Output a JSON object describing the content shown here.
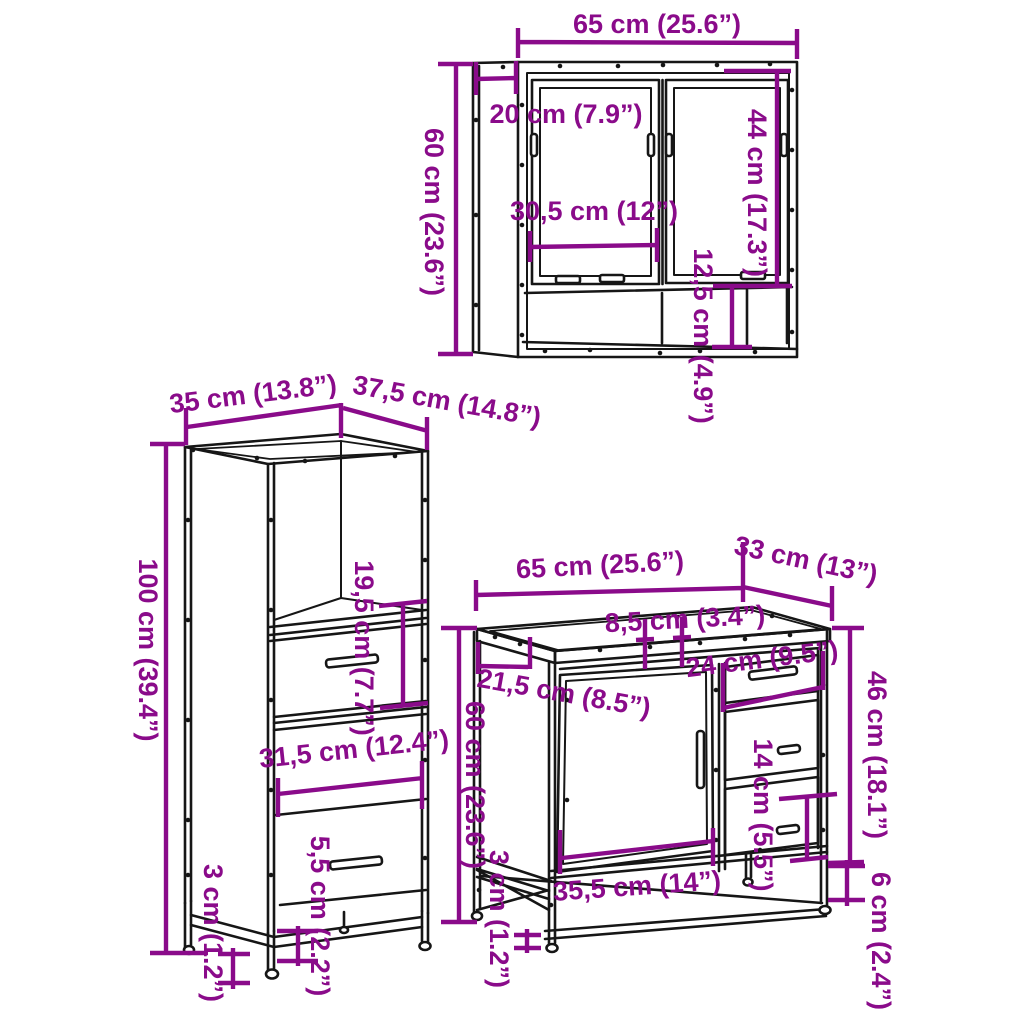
{
  "colors": {
    "dimension": "#8a0b8a",
    "outline": "#161616",
    "background": "#ffffff"
  },
  "mirror_cabinet": {
    "width": "65 cm (25.6”)",
    "height": "60 cm (23.6”)",
    "depth": "20 cm (7.9”)",
    "mirror_door_height": "44 cm (17.3”)",
    "mirror_door_width": "30,5 cm (12”)",
    "open_shelf_height": "12,5 cm (4.9”)"
  },
  "tall_cabinet": {
    "width": "35 cm (13.8”)",
    "depth": "37,5 cm (14.8”)",
    "height": "100 cm (39.4”)",
    "drawer_section_height": "19,5 cm (7.7”)",
    "inner_width": "31,5 cm (12.4”)",
    "clearance_height": "5,5 cm (2.2”)",
    "foot_height": "3 cm (1.2”)"
  },
  "sink_cabinet": {
    "width": "65 cm (25.6”)",
    "depth": "33 cm (13”)",
    "pipe_gap_width": "8,5 cm (3.4”)",
    "drawer_width": "24 cm (9.5”)",
    "top_side_depth": "21,5 cm (8.5”)",
    "height": "60 cm (23.6”)",
    "body_height": "46 cm (18.1”)",
    "drawer_height": "14 cm (5.5”)",
    "door_width": "35,5 cm (14”)",
    "foot_height": "3 cm (1.2”)",
    "leg_height": "6 cm (2.4”)"
  }
}
